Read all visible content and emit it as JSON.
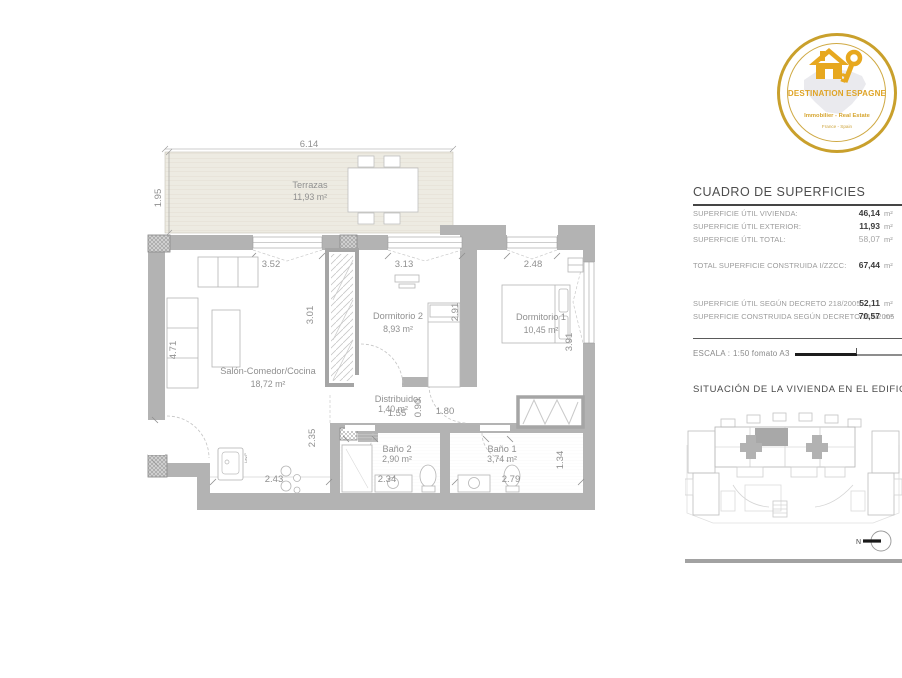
{
  "logo": {
    "title": "DESTINATION ESPAGNE",
    "subtitle": "Immobilier - Real Estate",
    "tagline": "France - Spain",
    "gold": "#d8a62a"
  },
  "surfaces": {
    "title": "CUADRO DE SUPERFICIES",
    "unit": "m²",
    "rows": [
      {
        "label": "SUPERFICIE ÚTIL VIVIENDA:",
        "value": "46,14"
      },
      {
        "label": "SUPERFICIE ÚTIL EXTERIOR:",
        "value": "11,93"
      },
      {
        "label": "SUPERFICIE ÚTIL TOTAL:",
        "value": "58,07"
      },
      {
        "label": "TOTAL SUPERFICIE CONSTRUIDA I/ZZCC:",
        "value": "67,44"
      },
      {
        "label": "SUPERFICIE ÚTIL SEGÚN DECRETO 218/2005",
        "value": "52,11"
      },
      {
        "label": "SUPERFICIE CONSTRUIDA SEGÚN DECRETO 218/2005",
        "value": "70,57"
      }
    ],
    "scale_label": "ESCALA :",
    "scale_value": "1:50 fomato A3"
  },
  "situation": {
    "title": "SITUACIÓN DE LA VIVIENDA EN EL EDIFICIO",
    "north": "N"
  },
  "plan": {
    "rooms": {
      "terraza": {
        "name": "Terrazas",
        "area": "11,93 m²"
      },
      "salon": {
        "name": "Salón-Comedor/Cocina",
        "area": "18,72 m²"
      },
      "dorm2": {
        "name": "Dormitorio 2",
        "area": "8,93 m²"
      },
      "dorm1": {
        "name": "Dormitorio 1",
        "area": "10,45 m²"
      },
      "distribuidor": {
        "name": "Distribuidor",
        "area": "1,40 m²"
      },
      "bano2": {
        "name": "Baño 2",
        "area": "2,90 m²"
      },
      "bano1": {
        "name": "Baño 1",
        "area": "3,74 m²"
      }
    },
    "dims": {
      "terrace_w": "6.14",
      "terrace_h": "1.95",
      "salon_w": "3.52",
      "dorm2_w": "3.13",
      "dorm1_w": "2.48",
      "salon_h_left": "4.71",
      "salon_h_mid": "3.01",
      "dorm2_h": "2.91",
      "dorm1_h": "3.91",
      "kitchen_h": "2.35",
      "kitchen_w": "2.43",
      "bano2_w": "2.34",
      "bano1_w": "2.79",
      "wardrobe_h": "1.34",
      "hall_w": "1.80",
      "hall_h": "0.90",
      "hall_w2": "1.55",
      "appliance": "Lav.P"
    }
  }
}
